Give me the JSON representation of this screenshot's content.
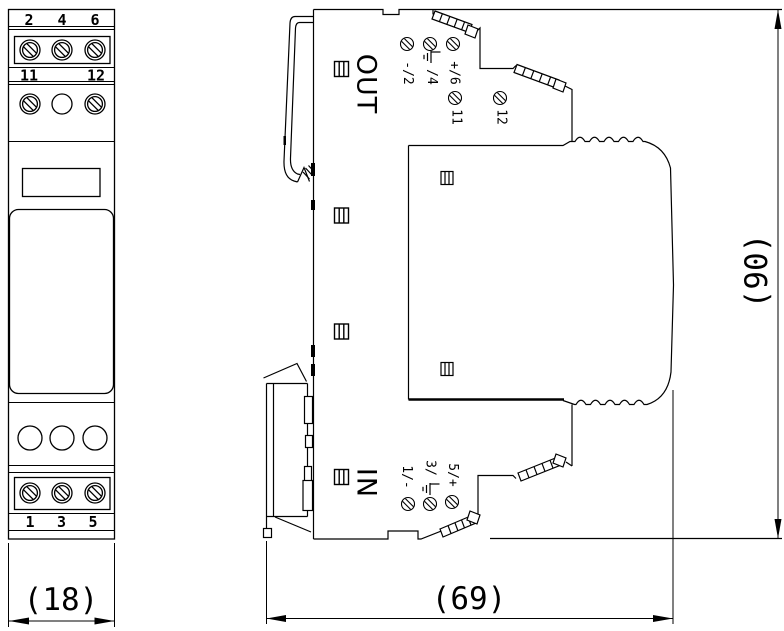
{
  "drawing": {
    "title": "DIN-rail signal converter module - dimensional drawing",
    "front_view": {
      "top_terminals": [
        "2",
        "4",
        "6"
      ],
      "mid_terminals": [
        "11",
        "12"
      ],
      "bottom_terminals": [
        "1",
        "3",
        "5"
      ]
    },
    "side_view": {
      "out_label": "OUT",
      "in_label": "IN",
      "out_terminals": {
        "minus": "-/2",
        "ground": "/4",
        "plus": "+/6"
      },
      "aux_terminals": {
        "t11": "11",
        "t12": "12"
      },
      "in_terminals": {
        "minus": "1/-",
        "ground": "3/",
        "plus": "5/+"
      }
    },
    "dimensions": {
      "width": "(18)",
      "depth": "(69)",
      "height": "(90)"
    },
    "icons": {
      "screw_terminal": "circle-slash",
      "earth_ground": "ground-bars",
      "indicator_window": "split-square"
    },
    "colors": {
      "line": "#000000",
      "background": "#ffffff"
    }
  }
}
